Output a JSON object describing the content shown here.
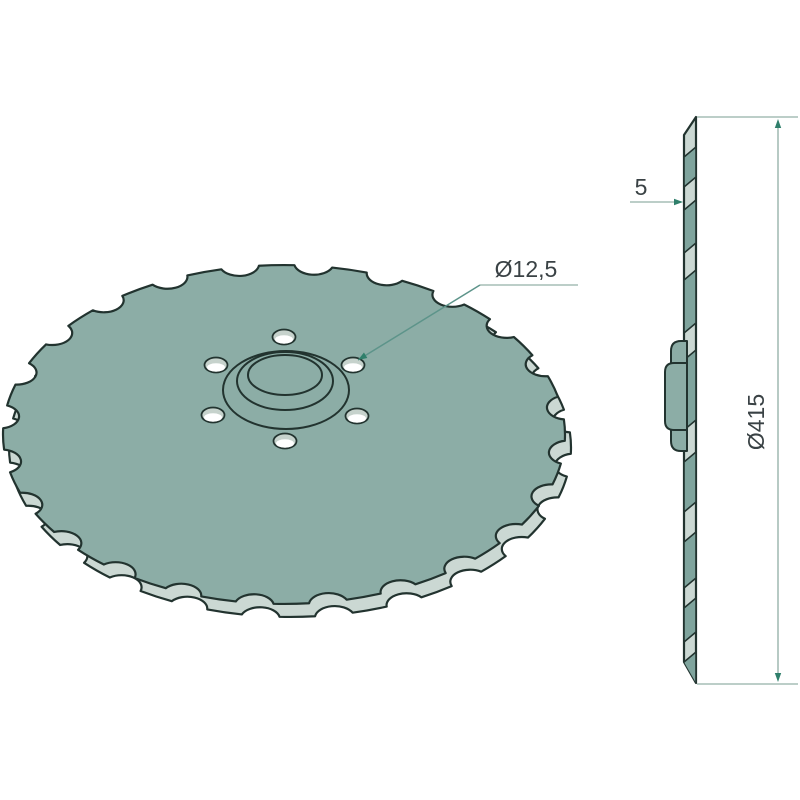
{
  "drawing": {
    "annotations": {
      "hole_diameter_label": "Ø12,5",
      "thickness_label": "5",
      "outer_diameter_label": "Ø415"
    },
    "colors": {
      "background": "#ffffff",
      "disc_face": "#8cada6",
      "disc_edge_light": "#cbd8d3",
      "stripe_dark": "#7fa49d",
      "outline": "#22332f",
      "dimension_line": "#a5bdb5",
      "leader_line": "#5d948a",
      "arrow": "#2f7f6b",
      "text": "#3a4245",
      "hole_shade": "#c6d2cc",
      "hole_highlight": "#ffffff"
    }
  }
}
